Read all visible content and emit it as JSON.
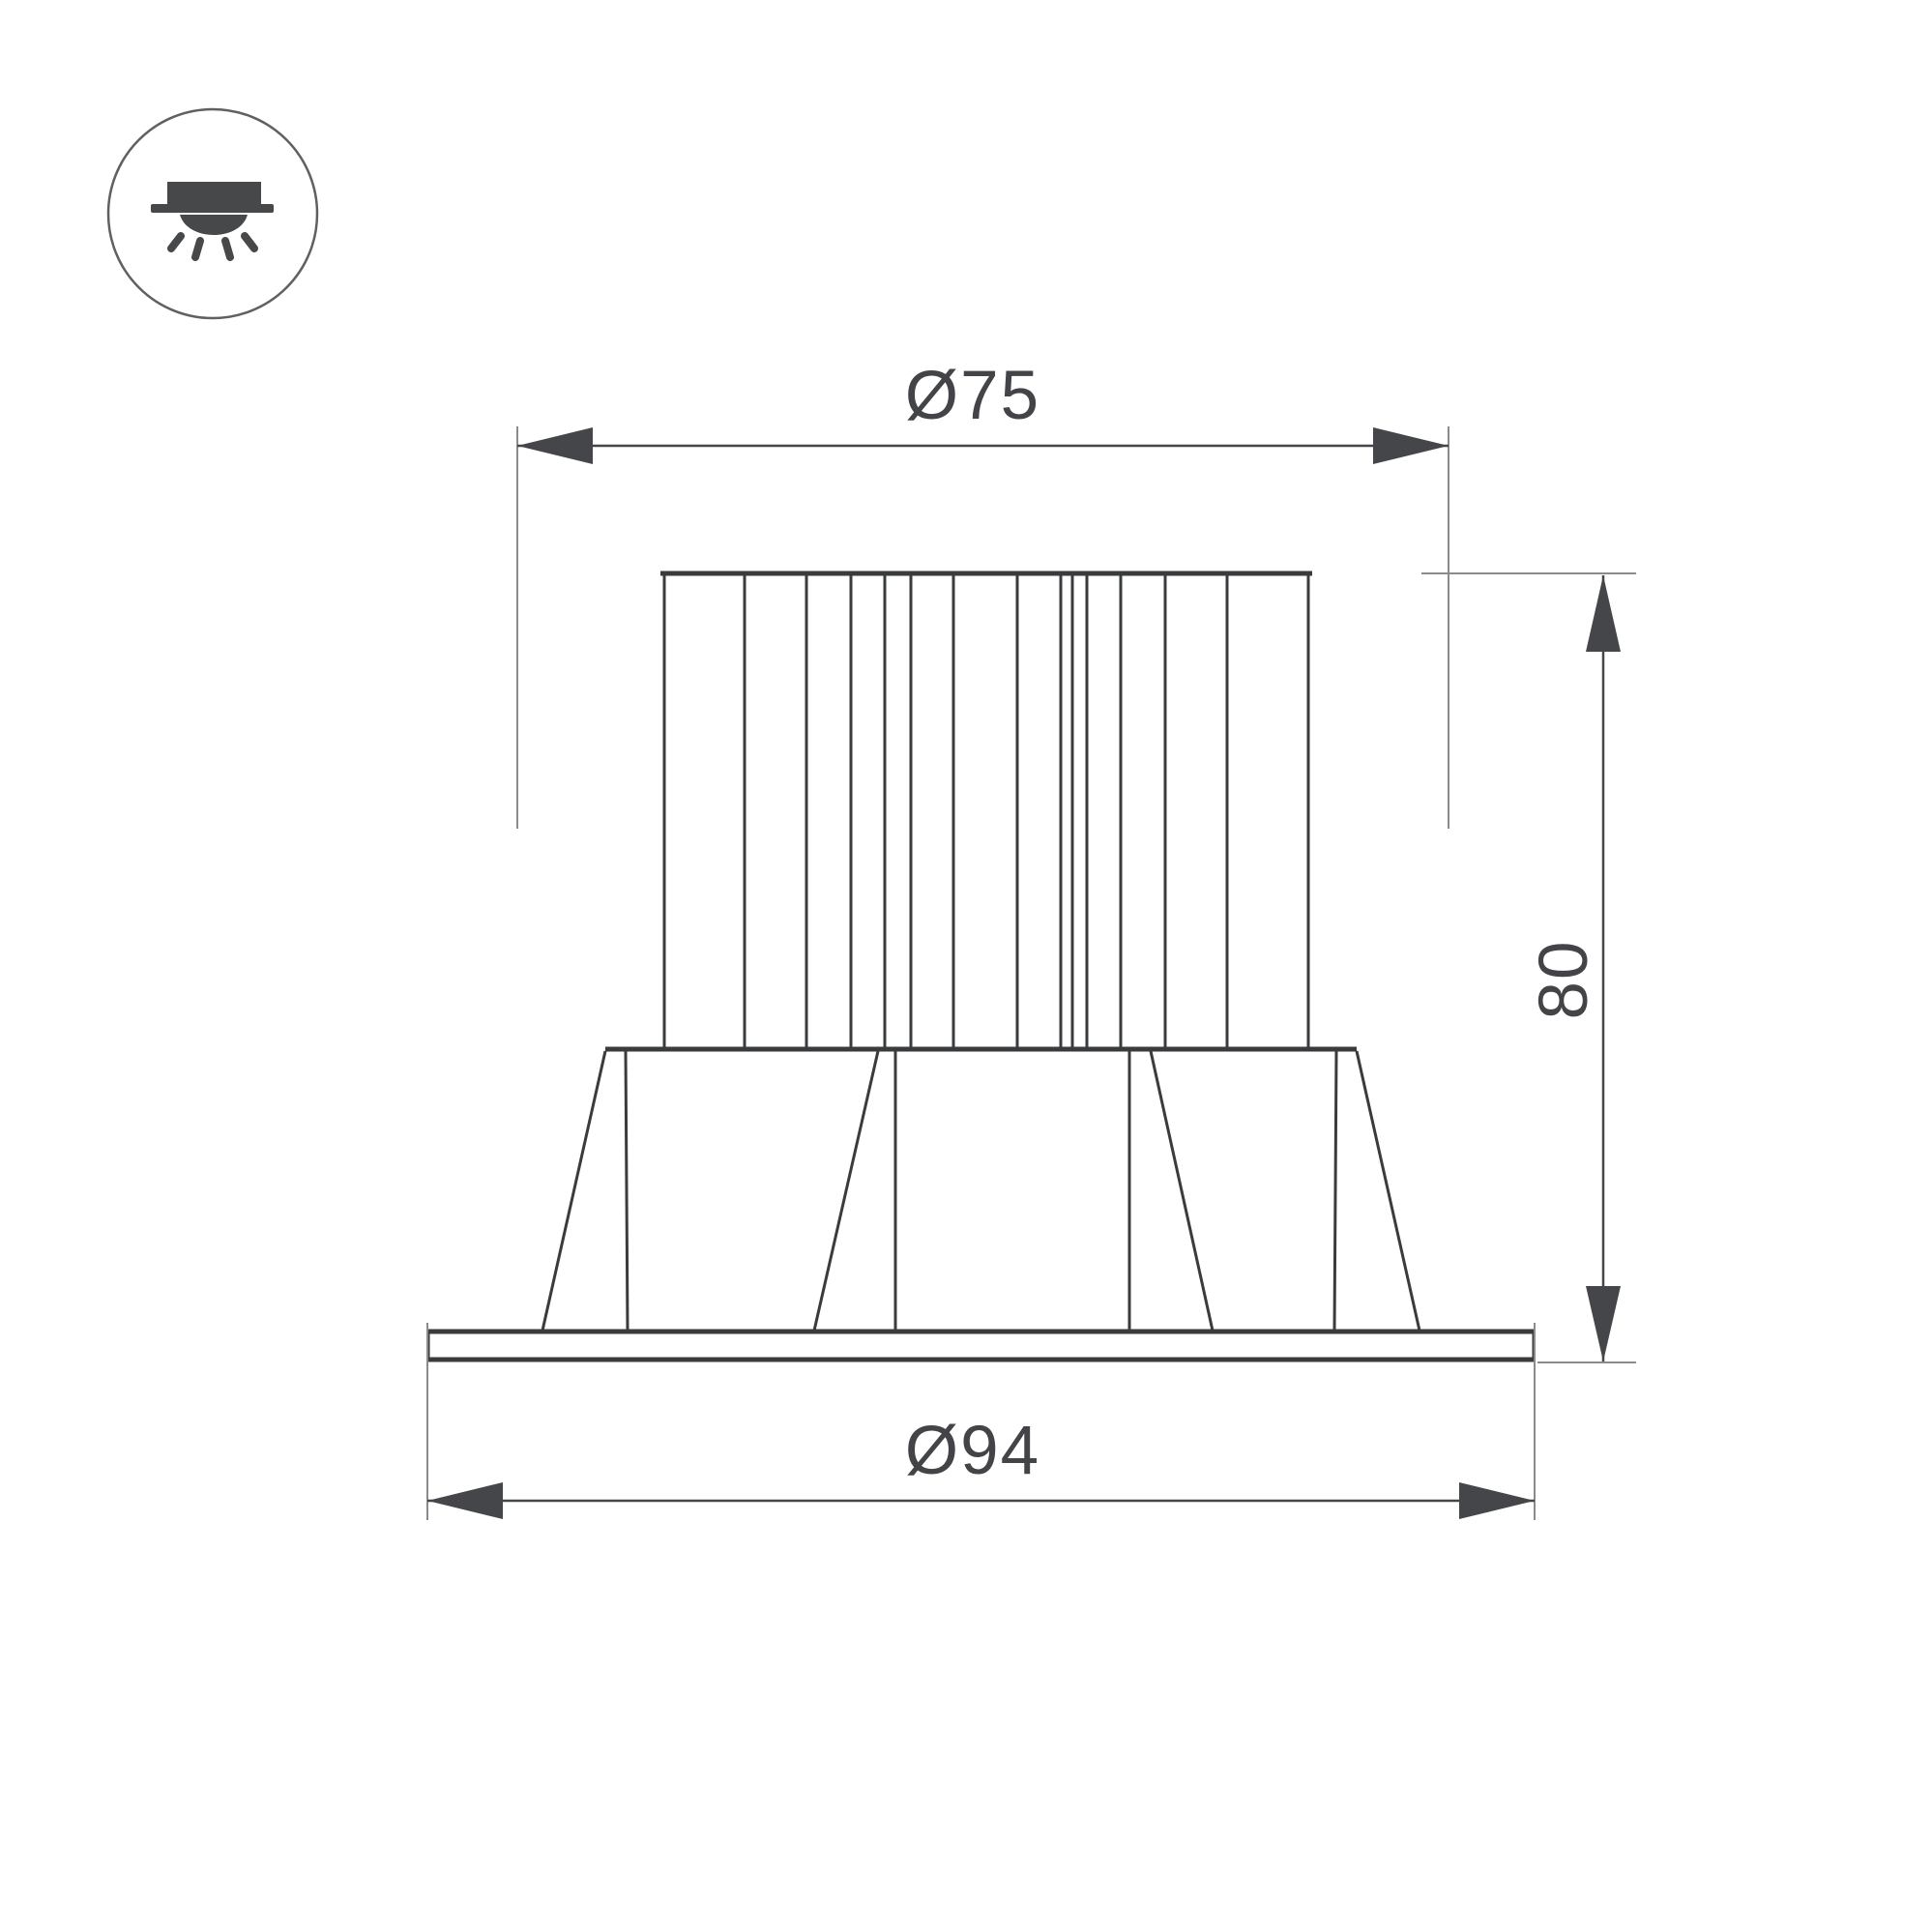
{
  "page": {
    "background": "#ffffff"
  },
  "icon": {
    "glyph": "recessed-downlight"
  },
  "drawing": {
    "labels": {
      "top_diameter": "Ø75",
      "height": "80",
      "flange_diameter": "Ø94"
    }
  },
  "colors": {
    "object_line": "#3a3b3d",
    "dimension_line": "#454649",
    "extension_line": "#8a8b8d",
    "text_color": "#434447",
    "icon_color": "#474849",
    "icon_ring": "#5f6063",
    "background": "#ffffff"
  }
}
